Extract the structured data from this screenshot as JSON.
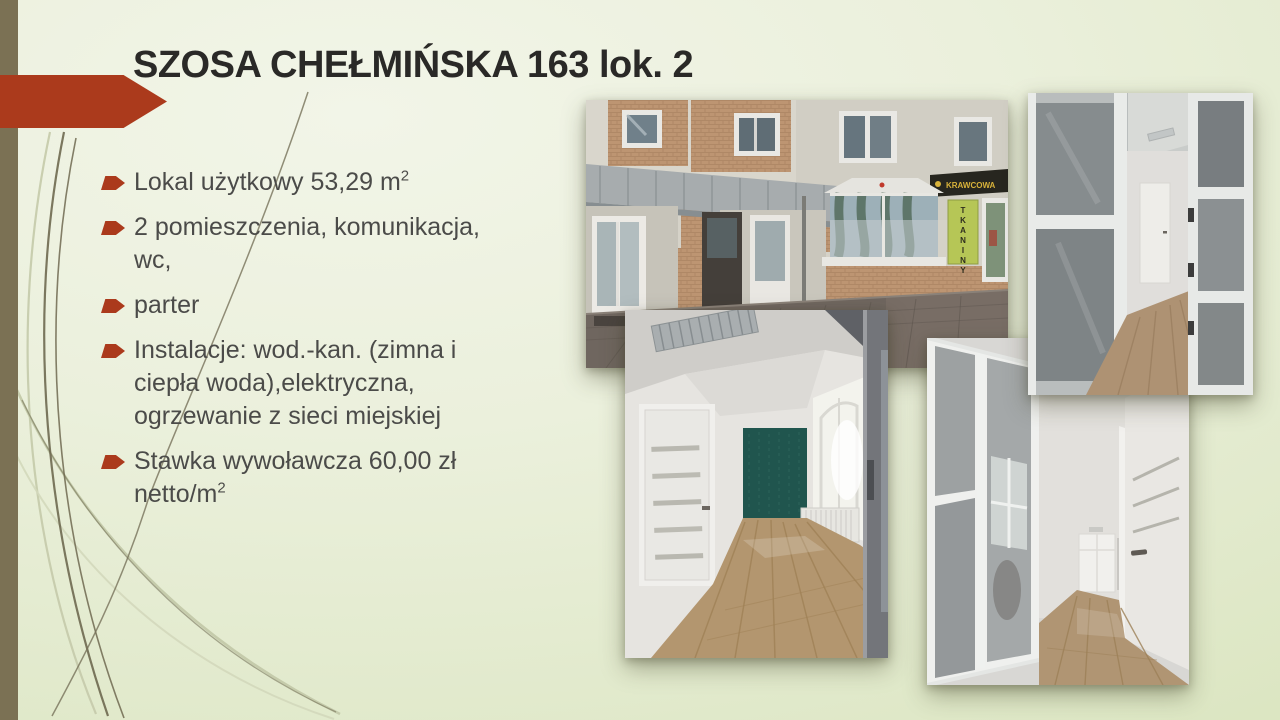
{
  "slide": {
    "title": "SZOSA CHEŁMIŃSKA 163 lok. 2",
    "bullets": [
      {
        "text": "Lokal użytkowy 53,29 m",
        "sup": "2"
      },
      {
        "text": "2 pomieszczenia, komunikacja, wc,",
        "sup": ""
      },
      {
        "text": "parter",
        "sup": ""
      },
      {
        "text": "Instalacje: wod.-kan. (zimna i ciepła woda),elektryczna, ogrzewanie z sieci miejskiej",
        "sup": ""
      },
      {
        "text": "Stawka wywoławcza 60,00 zł netto/m",
        "sup": "2"
      }
    ],
    "photo_signs": {
      "tkaniny": "TKANINY",
      "krawcowa": "KRAWCOWA"
    },
    "photos": [
      {
        "name": "building-exterior"
      },
      {
        "name": "glass-partition-interior"
      },
      {
        "name": "corridor-interior"
      },
      {
        "name": "narrow-room-interior"
      }
    ],
    "colors": {
      "accent_red": "#ab3a1c",
      "olive_bar": "#7b7154",
      "background_green": "#e3ecce",
      "text_dark": "#4b4b49",
      "teal_accent_wall": "#20554e",
      "sign_green": "#b6c656",
      "sign_text_yellow": "#d8b23a"
    }
  }
}
